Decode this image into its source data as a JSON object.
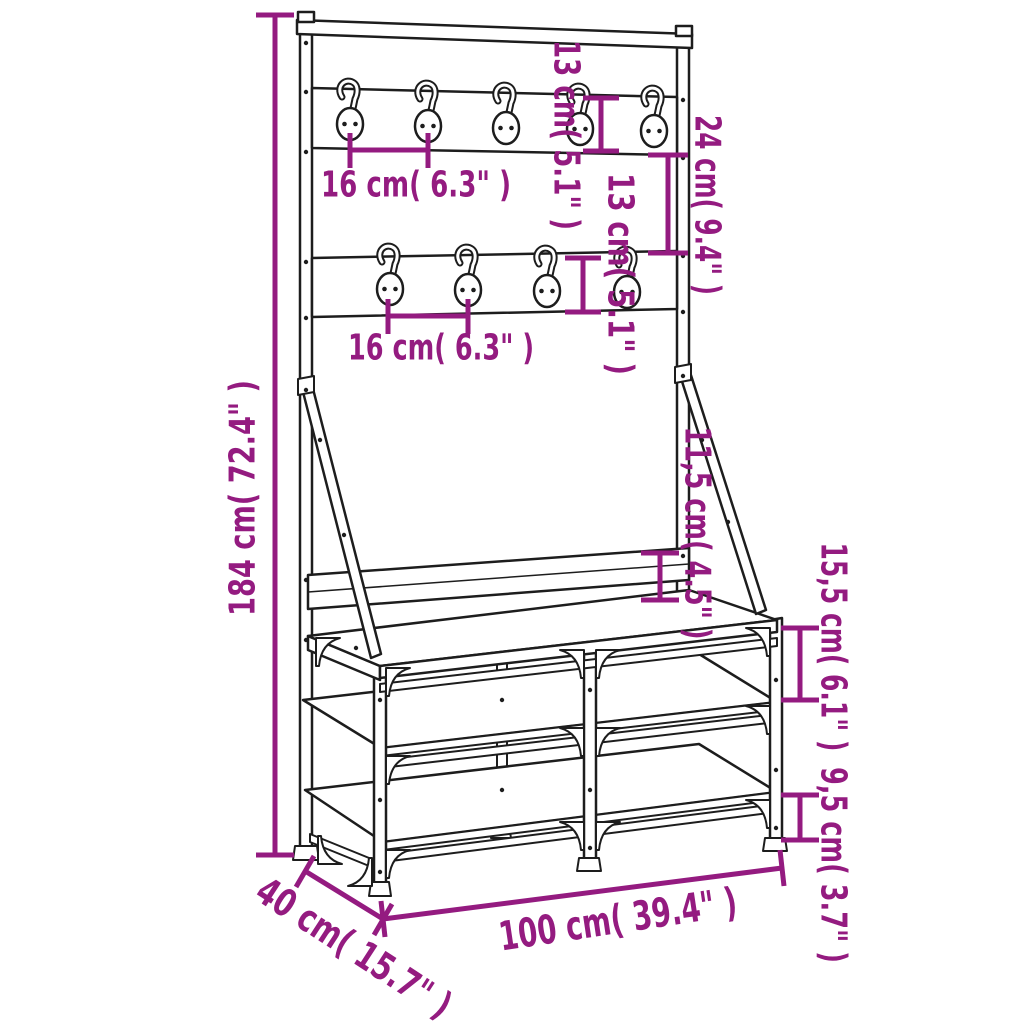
{
  "figure": {
    "kind": "furniture dimension diagram",
    "subject": "clothes rack with shoe storage bench and coat hooks",
    "background_color": "#ffffff",
    "accent_color": "#941b80",
    "outline_color": "#1d1d1d",
    "hook_count_top_row": 5,
    "hook_count_bottom_row": 4
  },
  "dimensions": {
    "total_height": {
      "label": "184 cm( 72.4\" )",
      "cm": 184,
      "inches": 72.4
    },
    "hook_spacing_top": {
      "label": "16 cm( 6.3\" )",
      "cm": 16,
      "inches": 6.3
    },
    "hook_spacing_bottom": {
      "label": "16 cm( 6.3\" )",
      "cm": 16,
      "inches": 6.3
    },
    "top_board_height": {
      "label": "13 cm( 5.1\" )",
      "cm": 13,
      "inches": 5.1
    },
    "between_boards": {
      "label": "24 cm( 9.4\" )",
      "cm": 24,
      "inches": 9.4
    },
    "bottom_board_height": {
      "label": "13 cm( 5.1\" )",
      "cm": 13,
      "inches": 5.1
    },
    "backboard_above_seat": {
      "label": "11,5 cm( 4.5\" )",
      "cm": 11.5,
      "inches": 4.5
    },
    "seat_to_shelf": {
      "label": "15,5 cm( 6.1\" )",
      "cm": 15.5,
      "inches": 6.1
    },
    "bottom_shelf_clearance": {
      "label": "9,5 cm( 3.7\" )",
      "cm": 9.5,
      "inches": 3.7
    },
    "total_width": {
      "label": "100 cm( 39.4\" )",
      "cm": 100,
      "inches": 39.4
    },
    "total_depth": {
      "label": "40 cm( 15.7\" )",
      "cm": 40,
      "inches": 15.7
    }
  }
}
